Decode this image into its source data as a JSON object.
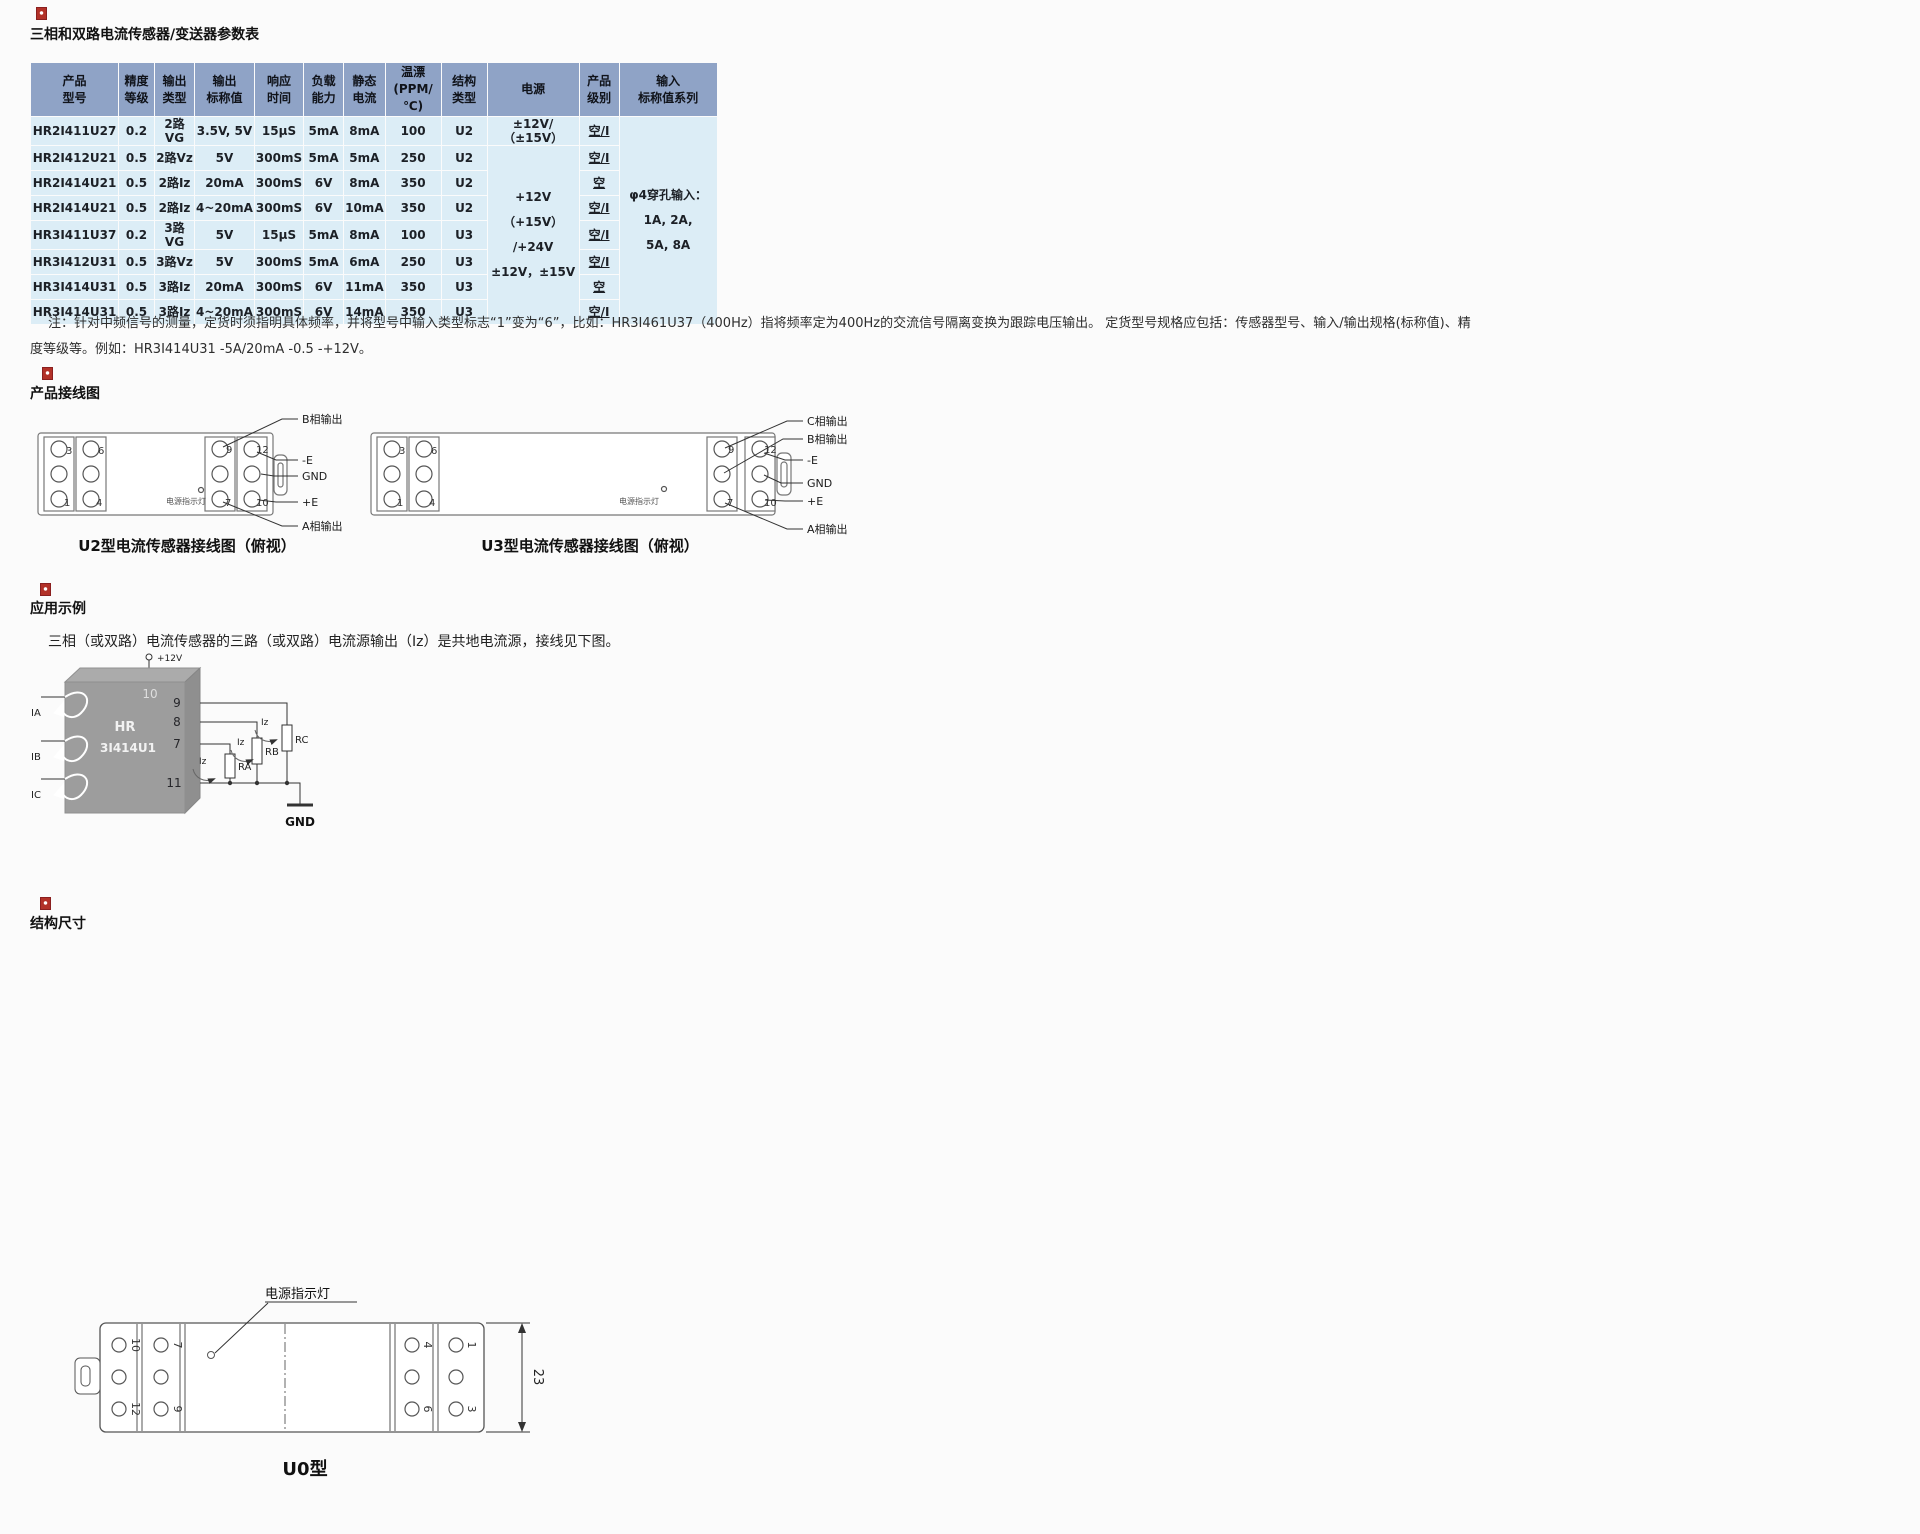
{
  "colors": {
    "accent_red": "#b23128",
    "table_header_bg": "#8fa3c6",
    "table_row_bg": "#dcedf6",
    "line": "#555555"
  },
  "params_section": {
    "title": "三相和双路电流传感器/变送器参数表",
    "table": {
      "headers": [
        {
          "l1": "产品",
          "l2": "型号"
        },
        {
          "l1": "精度",
          "l2": "等级"
        },
        {
          "l1": "输出",
          "l2": "类型"
        },
        {
          "l1": "输出",
          "l2": "标称值"
        },
        {
          "l1": "响应",
          "l2": "时间"
        },
        {
          "l1": "负载",
          "l2": "能力"
        },
        {
          "l1": "静态",
          "l2": "电流"
        },
        {
          "l1": "温漂",
          "l2": "(PPM/℃)"
        },
        {
          "l1": "结构",
          "l2": "类型"
        },
        {
          "l1": "电源",
          "l2": ""
        },
        {
          "l1": "产品",
          "l2": "级别"
        },
        {
          "l1": "输入",
          "l2": "标称值系列"
        }
      ],
      "rows": [
        {
          "model": "HR2I411U27",
          "accuracy": "0.2",
          "out_type": "2路VG",
          "out_nominal": "3.5V, 5V",
          "response": "15μS",
          "load": "5mA",
          "quiescent": "8mA",
          "drift": "100",
          "structure": "U2",
          "grade": "空/I"
        },
        {
          "model": "HR2I412U21",
          "accuracy": "0.5",
          "out_type": "2路Vz",
          "out_nominal": "5V",
          "response": "300mS",
          "load": "5mA",
          "quiescent": "5mA",
          "drift": "250",
          "structure": "U2",
          "grade": "空/I"
        },
        {
          "model": "HR2I414U21",
          "accuracy": "0.5",
          "out_type": "2路Iz",
          "out_nominal": "20mA",
          "response": "300mS",
          "load": "6V",
          "quiescent": "8mA",
          "drift": "350",
          "structure": "U2",
          "grade": "空"
        },
        {
          "model": "HR2I414U21",
          "accuracy": "0.5",
          "out_type": "2路Iz",
          "out_nominal": "4~20mA",
          "response": "300mS",
          "load": "6V",
          "quiescent": "10mA",
          "drift": "350",
          "structure": "U2",
          "grade": "空/I"
        },
        {
          "model": "HR3I411U37",
          "accuracy": "0.2",
          "out_type": "3路VG",
          "out_nominal": "5V",
          "response": "15μS",
          "load": "5mA",
          "quiescent": "8mA",
          "drift": "100",
          "structure": "U3",
          "grade": "空/I"
        },
        {
          "model": "HR3I412U31",
          "accuracy": "0.5",
          "out_type": "3路Vz",
          "out_nominal": "5V",
          "response": "300mS",
          "load": "5mA",
          "quiescent": "6mA",
          "drift": "250",
          "structure": "U3",
          "grade": "空/I"
        },
        {
          "model": "HR3I414U31",
          "accuracy": "0.5",
          "out_type": "3路Iz",
          "out_nominal": "20mA",
          "response": "300mS",
          "load": "6V",
          "quiescent": "11mA",
          "drift": "350",
          "structure": "U3",
          "grade": "空"
        },
        {
          "model": "HR3I414U31",
          "accuracy": "0.5",
          "out_type": "3路Iz",
          "out_nominal": "4~20mA",
          "response": "300mS",
          "load": "6V",
          "quiescent": "14mA",
          "drift": "350",
          "structure": "U3",
          "grade": "空/I"
        }
      ],
      "power_row1": "±12V/（±15V）",
      "power_merged_l1": "+12V（+15V）",
      "power_merged_l2": "/+24V",
      "power_merged_l3": "±12V，±15V",
      "input_series_l1": "φ4穿孔输入：",
      "input_series_l2": "1A, 2A,",
      "input_series_l3": "5A, 8A"
    },
    "note_line1": "注：针对中频信号的测量，定货时须指明具体频率，并将型号中输入类型标志“1”变为“6”，比如：HR3I461U37（400Hz）指将频率定为400Hz的交流信号隔离变换为跟踪电压输出。 定货型号规格应包括：传感器型号、输入/输出规格(标称值)、精",
    "note_line2": "度等级等。例如：HR3I414U31 -5A/20mA -0.5 -+12V。"
  },
  "wiring_section": {
    "title": "产品接线图",
    "u2": {
      "caption": "U2型电流传感器接线图（俯视）",
      "led_label": "电源指示灯",
      "t3": "3",
      "t6": "6",
      "t1": "1",
      "t4": "4",
      "t9": "9",
      "t12": "12",
      "t7": "7",
      "t10": "10",
      "b_out": "B相输出",
      "neg_e": "-E",
      "gnd": "GND",
      "pos_e": "+E",
      "a_out": "A相输出"
    },
    "u3": {
      "caption": "U3型电流传感器接线图（俯视）",
      "led_label": "电源指示灯",
      "t3": "3",
      "t6": "6",
      "t1": "1",
      "t4": "4",
      "t9": "9",
      "t12": "12",
      "t7": "7",
      "t10": "10",
      "c_out": "C相输出",
      "b_out": "B相输出",
      "neg_e": "-E",
      "gnd": "GND",
      "pos_e": "+E",
      "a_out": "A相输出"
    }
  },
  "application_section": {
    "title": "应用示例",
    "description": "三相（或双路）电流传感器的三路（或双路）电流源输出（Iz）是共地电流源，接线见下图。",
    "circuit": {
      "supply": "+12V",
      "chip_l1": "HR",
      "chip_l2": "3I414U1",
      "pin10": "10",
      "pin9": "9",
      "pin8": "8",
      "pin7": "7",
      "pin11": "11",
      "in_a": "IA",
      "in_b": "IB",
      "in_c": "IC",
      "iz1": "Iz",
      "iz2": "Iz",
      "iz3": "Iz",
      "r_a": "RA",
      "r_b": "RB",
      "r_c": "RC",
      "gnd": "GND"
    }
  },
  "dimensions_section": {
    "title": "结构尺寸",
    "front": {
      "hole_a": "A",
      "hole_b": "B",
      "hole_c": "C",
      "dim_slot": "35",
      "dim_width": "101",
      "dim_height": "70.5"
    },
    "bottom": {
      "led_label": "电源指示灯",
      "dim_height": "23",
      "caption": "U0型",
      "t10": "10",
      "t7": "7",
      "t12": "12",
      "t9": "9",
      "t4": "4",
      "t1": "1",
      "t6": "6",
      "t3": "3"
    }
  }
}
